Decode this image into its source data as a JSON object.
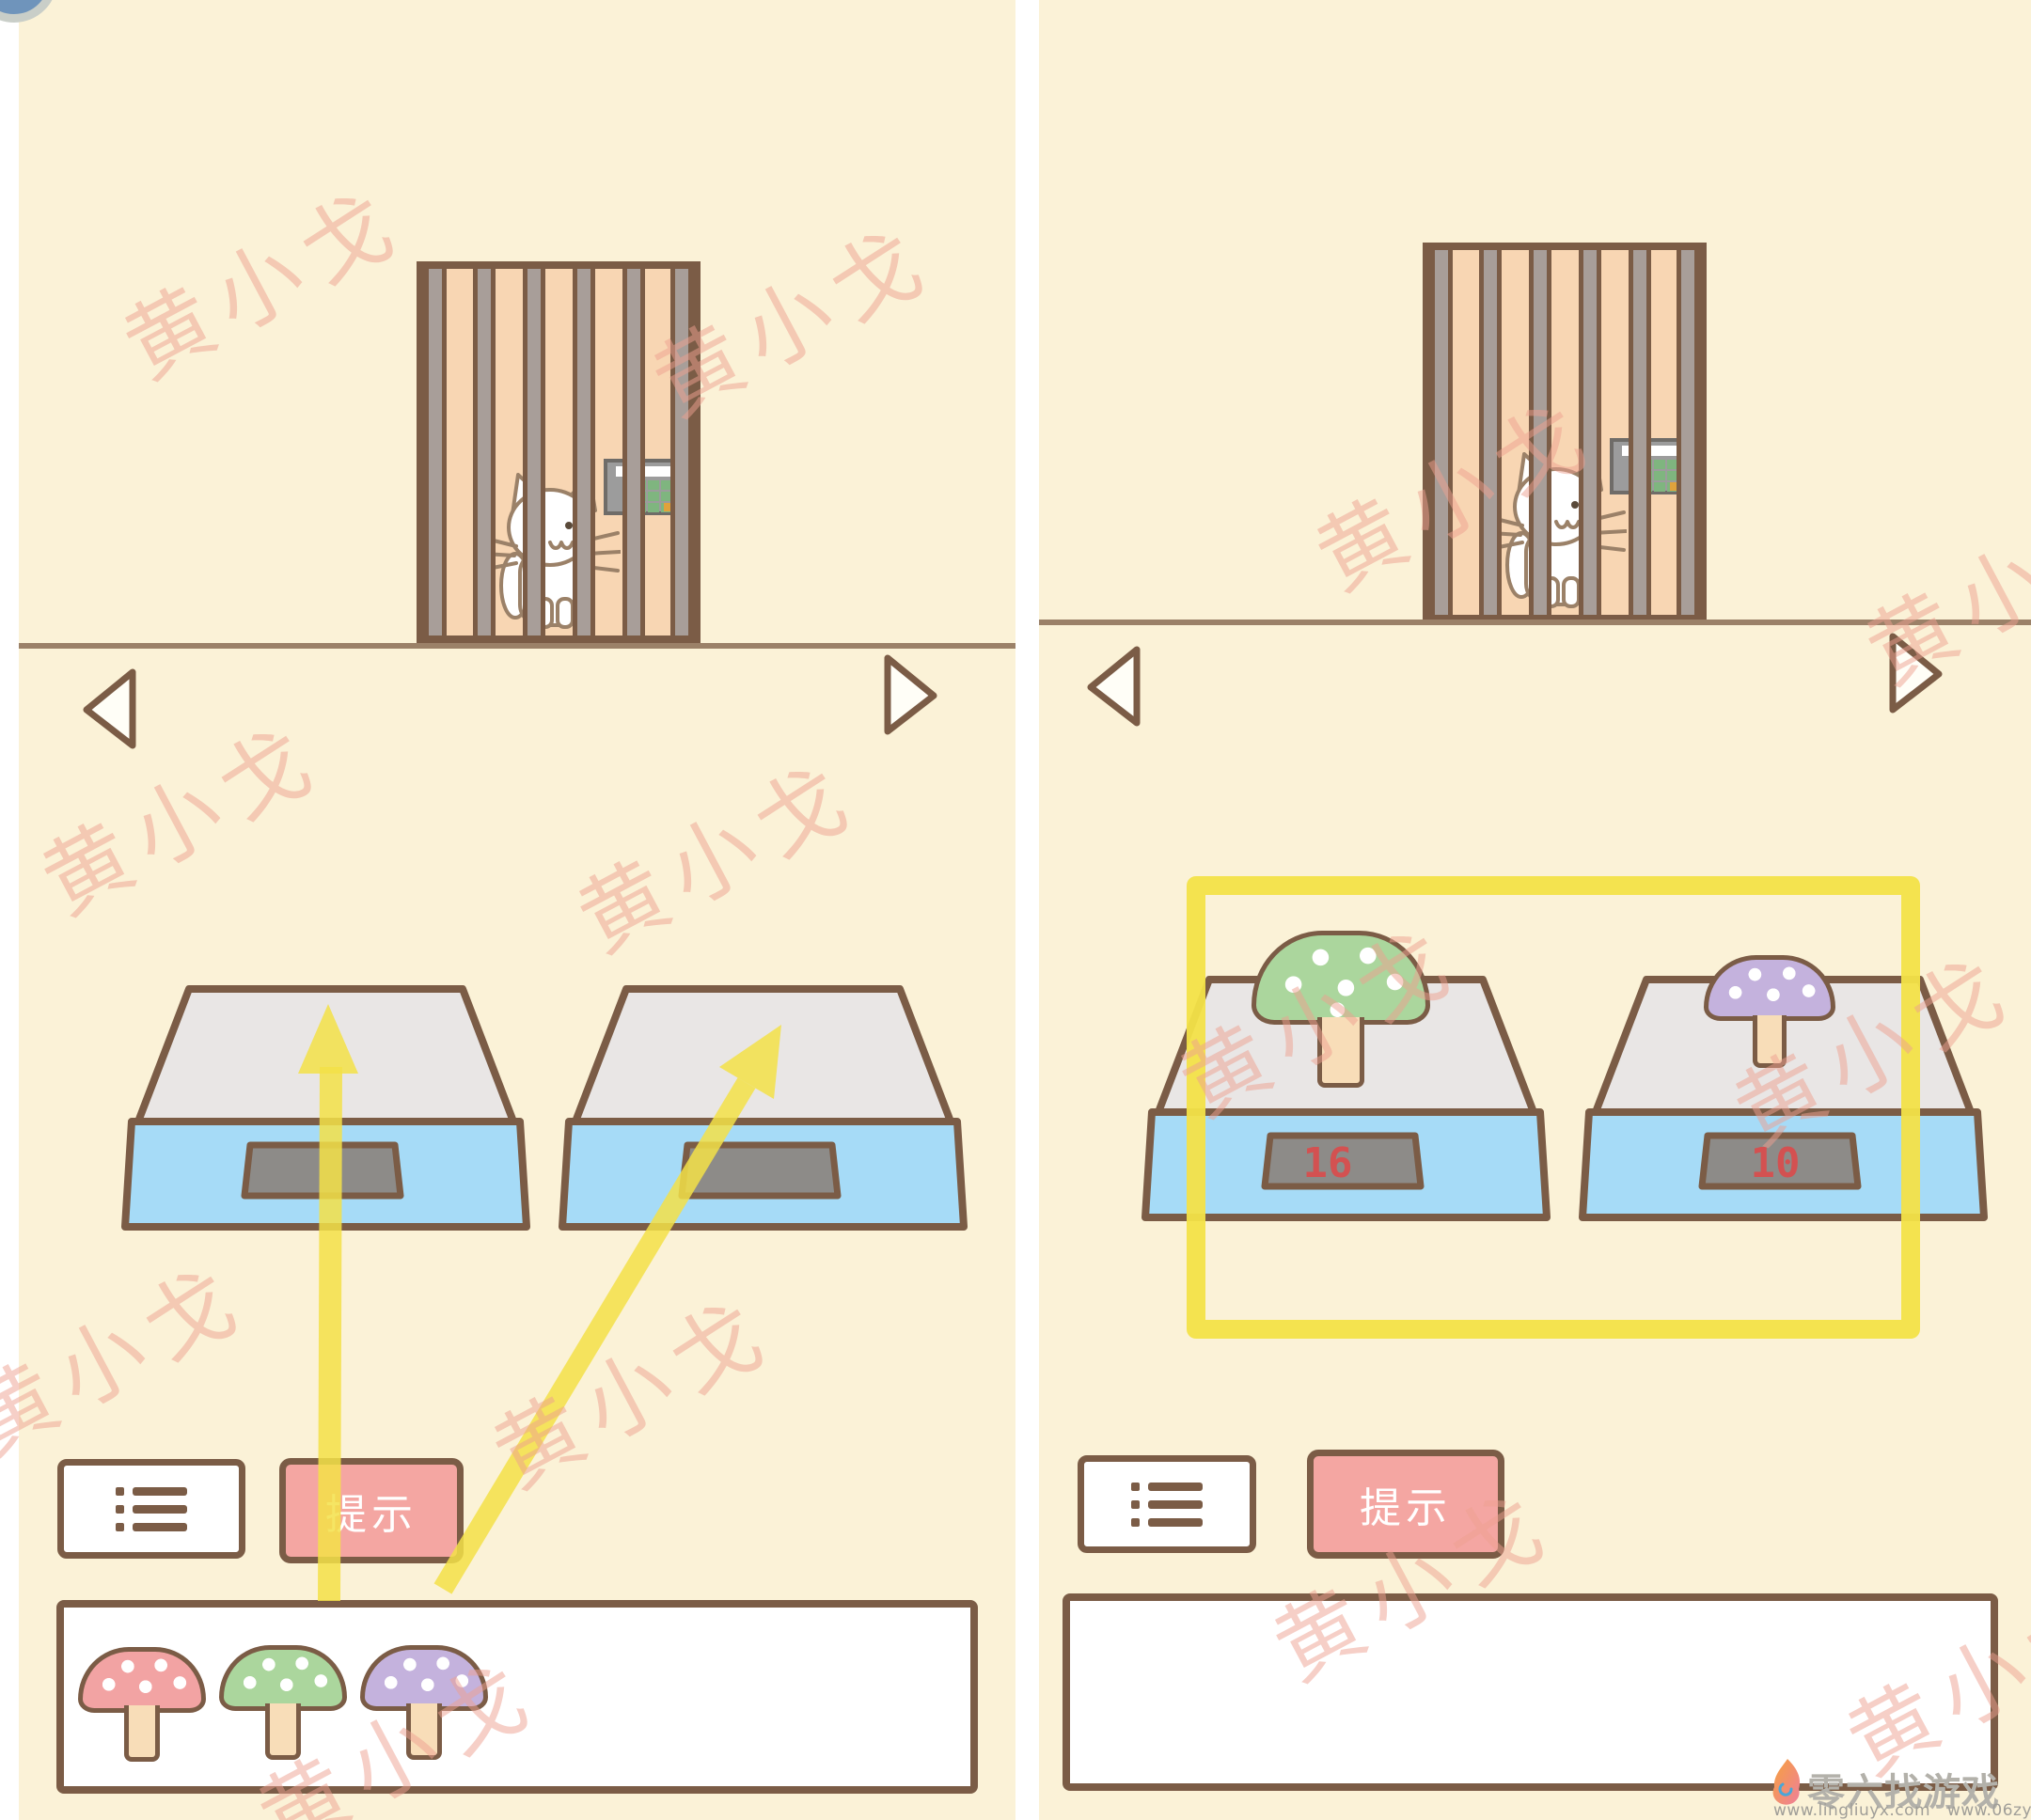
{
  "watermark": {
    "text": "黄小戈"
  },
  "panels": [
    {
      "name": "left",
      "hint_button_label": "提示",
      "scales": [
        {
          "display_value": ""
        },
        {
          "display_value": ""
        }
      ],
      "inventory_mushrooms": [
        {
          "color_name": "pink",
          "cap_color": "#f2a3a3"
        },
        {
          "color_name": "green",
          "cap_color": "#abd69d"
        },
        {
          "color_name": "purple",
          "cap_color": "#c4b2dd"
        }
      ]
    },
    {
      "name": "right",
      "hint_button_label": "提示",
      "scales": [
        {
          "display_value": "16",
          "mushroom": "green"
        },
        {
          "display_value": "10",
          "mushroom": "purple"
        }
      ],
      "inventory_mushrooms": []
    }
  ],
  "logo": {
    "site_name": "零六找游戏",
    "urls": "www.lingliuyx.com   www.06zyx.com"
  },
  "colors": {
    "background_cream": "#fbf2d7",
    "outline_brown": "#7b5c46",
    "cage_peach": "#f8d6b3",
    "bar_gray": "#a89e99",
    "scale_top_gray": "#e9e6e5",
    "scale_base_blue": "#a6dbf7",
    "display_gray": "#8d8b88",
    "display_number_red": "#e04848",
    "accent_yellow": "#f3e148",
    "hint_pink": "#f4a6a2",
    "watermark_pink": "#ee9f8f"
  }
}
